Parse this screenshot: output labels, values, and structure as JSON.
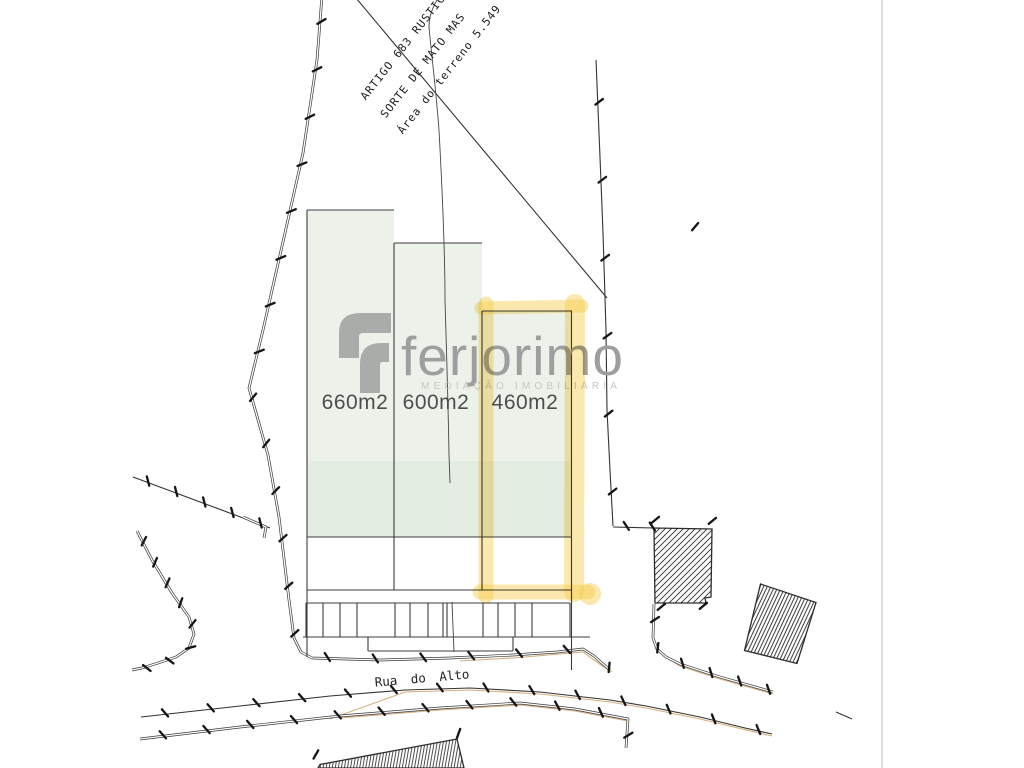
{
  "annotations": {
    "artigo": "ARTIGO 683 RUSTICO",
    "sorte": "SORTE DE MATO MAS",
    "area": "Área do terreno   5.549"
  },
  "plots": [
    {
      "area_label": "660m2"
    },
    {
      "area_label": "600m2"
    },
    {
      "area_label": "460m2"
    }
  ],
  "street_label": "Rua do Alto",
  "logo": {
    "name": "ferjorimo",
    "tagline": "MEDIAÇÃO IMOBILIÁRIA"
  },
  "colors": {
    "plot_fill_light": "#ecf2ea",
    "plot_fill_dark": "#e4ede1",
    "highlight_yellow": "#f6cd4c",
    "line_dark": "#2e2e2e",
    "logo_glyph_gray": "#a8ada9",
    "logo_text_gray": "#9e9e9e",
    "tagline_gray": "#c8c7c5",
    "label_gray": "#4d4d4d",
    "road_tan": "#cfa36b",
    "page_divider": "#dcdcdc"
  }
}
